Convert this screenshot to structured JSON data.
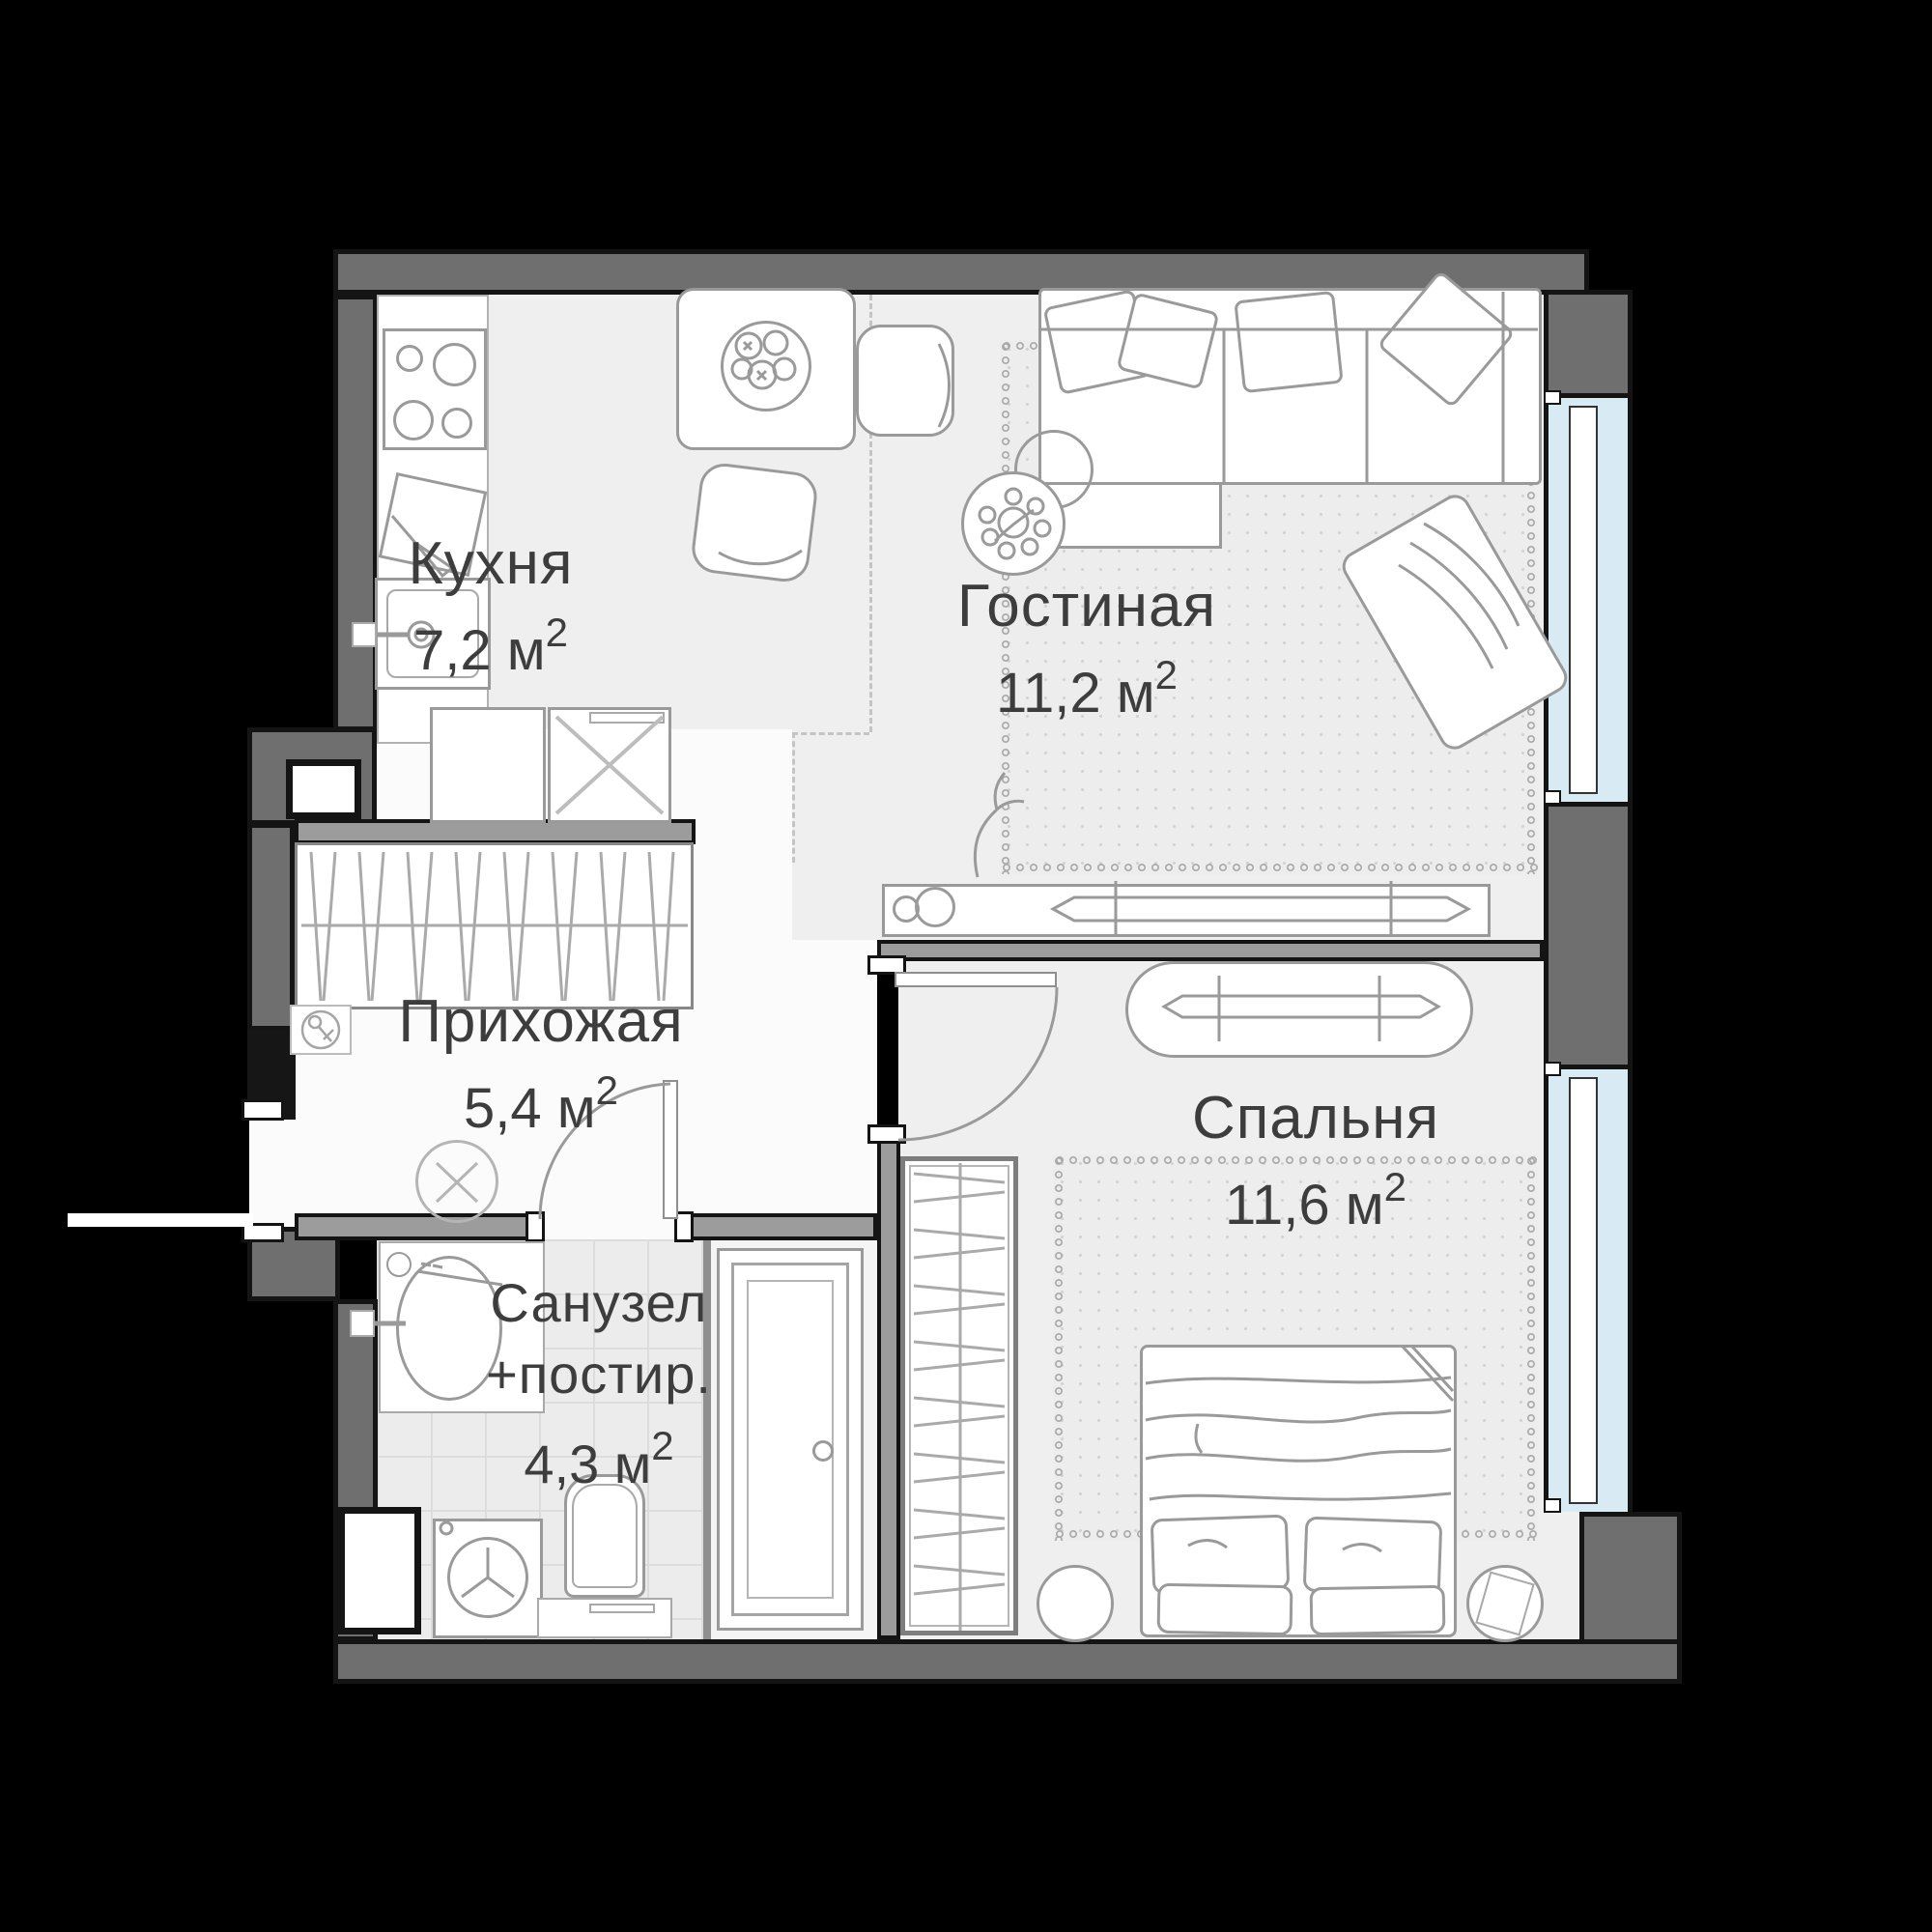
{
  "plan": {
    "type": "apartment-floor-plan",
    "language": "ru",
    "rooms": [
      {
        "id": "kitchen",
        "name": "Кухня",
        "area": "7,2 м",
        "area_sup": "2"
      },
      {
        "id": "living",
        "name": "Гостиная",
        "area": "11,2 м",
        "area_sup": "2"
      },
      {
        "id": "hallway",
        "name": "Прихожая",
        "area": "5,4 м",
        "area_sup": "2"
      },
      {
        "id": "bathroom",
        "name": "Санузел",
        "name2": "+постир.",
        "area": "4,3 м",
        "area_sup": "2"
      },
      {
        "id": "bedroom",
        "name": "Спальня",
        "area": "11,6 м",
        "area_sup": "2"
      }
    ],
    "colors": {
      "background": "#000000",
      "exterior_wall": "#6f6f6f",
      "interior_wall": "#9c9c9c",
      "outline": "#141414",
      "window_glass": "#d8ebf4",
      "floor": "#efefef",
      "floor_hallway": "#fbfbfb",
      "floor_bathroom": "#ececec",
      "furniture_line": "#9a9a9a",
      "label_text": "#3d3d3d"
    },
    "icons": {
      "entry": "key-icon",
      "hallway_ceiling": "ceiling-light-icon",
      "kitchen": [
        "stove-icon",
        "cutting-board-icon",
        "sink-icon",
        "tall-cabinet-x-icon"
      ],
      "bathroom": [
        "vanity-sink-icon",
        "washing-machine-icon",
        "toilet-icon"
      ],
      "windows": 2
    }
  }
}
